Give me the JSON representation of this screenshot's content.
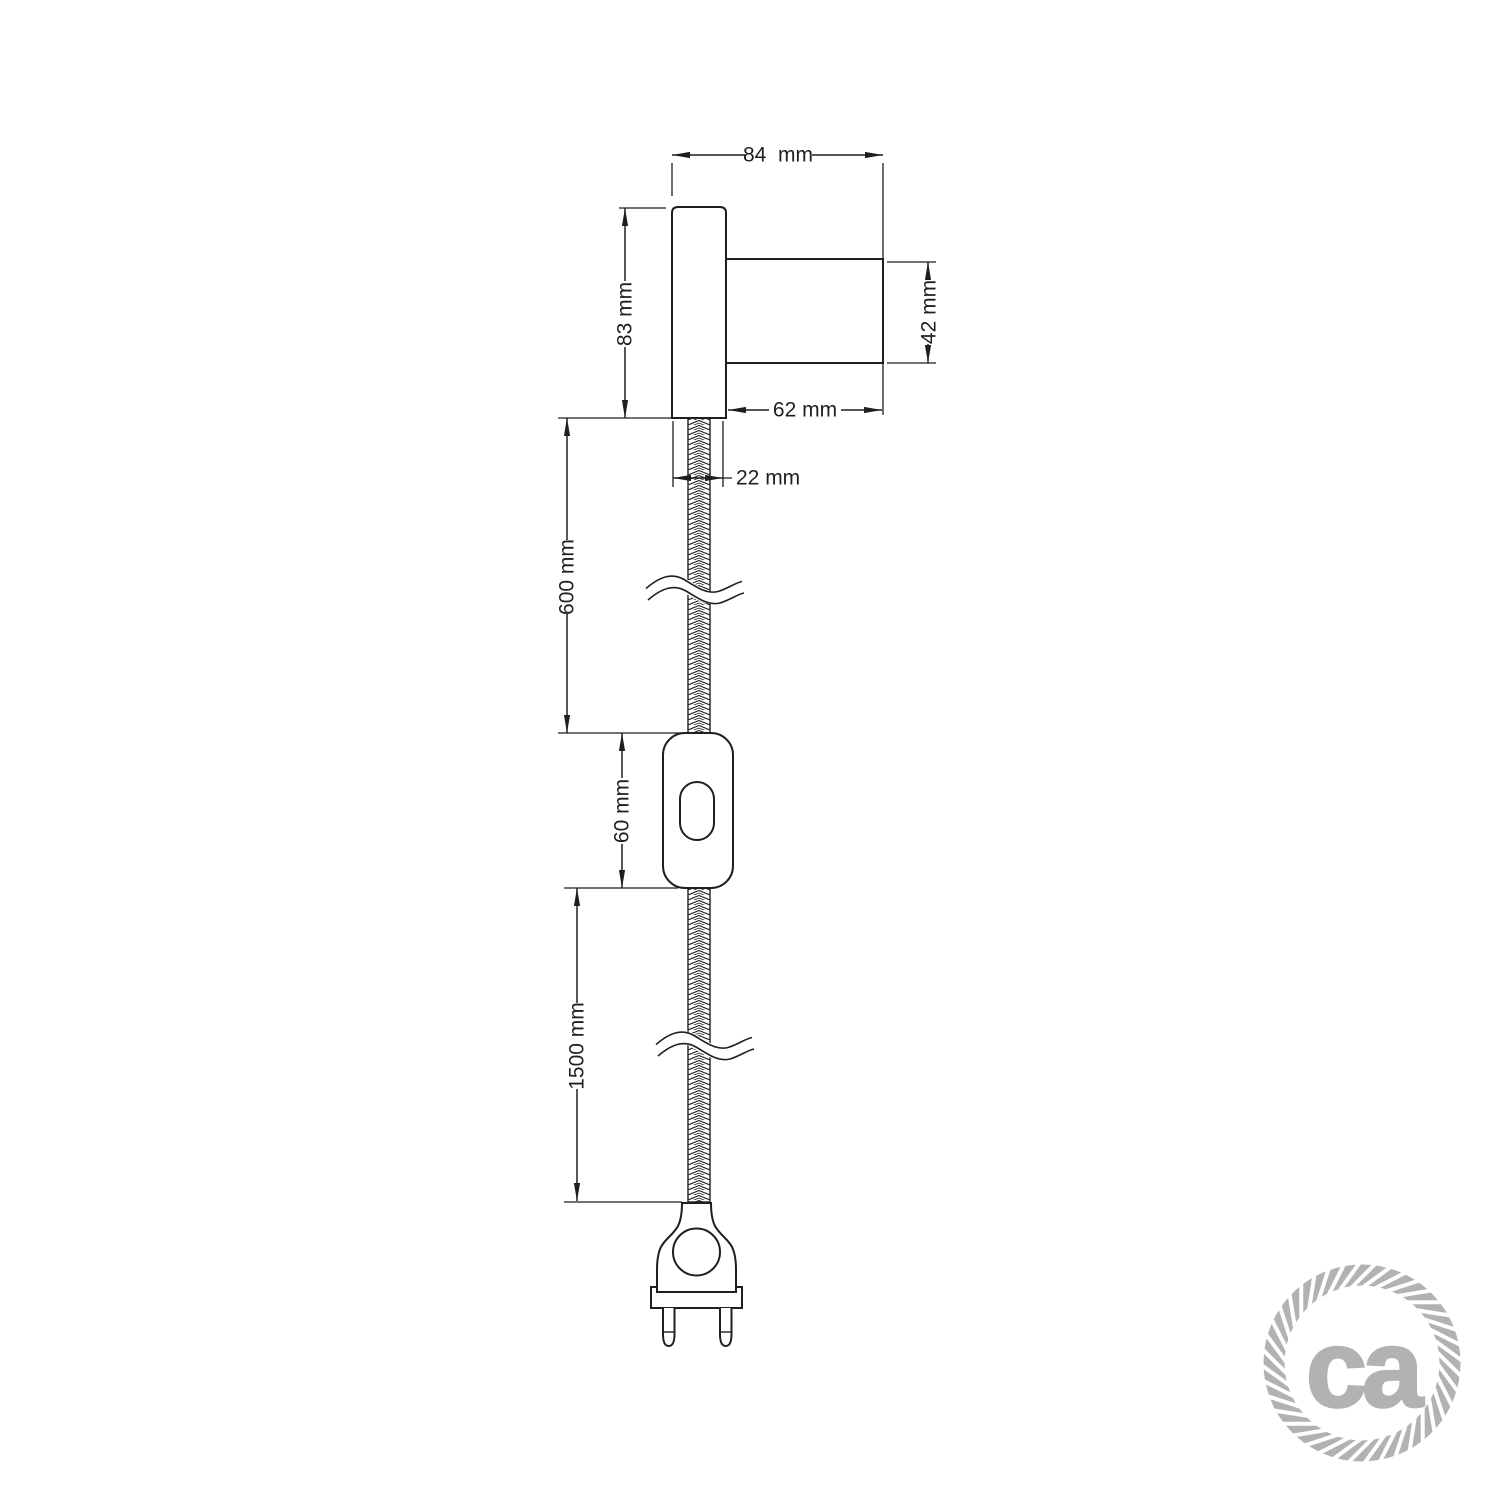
{
  "drawing": {
    "line_color": "#1f1f1f",
    "background": "#ffffff",
    "dimensions": {
      "total_width": "84  mm",
      "plate_height": "83 mm",
      "socket_diameter": "42 mm",
      "socket_length": "62 mm",
      "plate_thickness": "22 mm",
      "upper_cable_length": "600 mm",
      "switch_length": "60 mm",
      "lower_cable_length": "1500 mm"
    }
  },
  "logo": {
    "text": "ca",
    "color": "#b2b2b2"
  }
}
